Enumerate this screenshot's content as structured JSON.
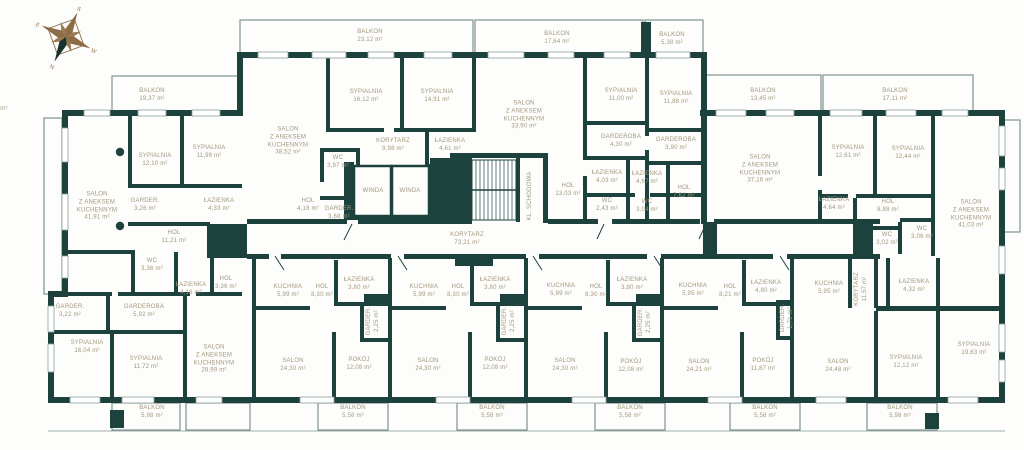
{
  "title": "Rzut kondygnacji / floor plan",
  "colors": {
    "wall": "#1d423e",
    "label_text": "#a3977f",
    "balcony_outline": "#7c948f",
    "compass_brown": "#8d6c48",
    "compass_dark": "#16332f",
    "background": "#fdfdfb"
  },
  "compass": {
    "n": "N",
    "s": "S",
    "e": "E",
    "w": "W"
  },
  "rooms": [
    {
      "n": "BALKON",
      "a": "19,37 m²",
      "x": 152,
      "y": 96
    },
    {
      "n": "BALKON",
      "a": "23,12 m²",
      "x": 370,
      "y": 37
    },
    {
      "n": "BALKON",
      "a": "17,64 m²",
      "x": 557,
      "y": 39
    },
    {
      "n": "BALKON",
      "a": "5,38 m²",
      "x": 672,
      "y": 40
    },
    {
      "n": "BALKON",
      "a": "13,45 m²",
      "x": 763,
      "y": 96
    },
    {
      "n": "BALKON",
      "a": "17,11 m²",
      "x": 895,
      "y": 96
    },
    {
      "n": "SALON\nZ ANEKSEM\nKUCHENNYM",
      "a": "41,91 m²",
      "x": 97,
      "y": 207
    },
    {
      "n": "SYPIALNIA",
      "a": "12,10 m²",
      "x": 155,
      "y": 161
    },
    {
      "n": "SYPIALNIA",
      "a": "11,99 m²",
      "x": 209,
      "y": 153
    },
    {
      "n": "GARDER.",
      "a": "3,26 m²",
      "x": 145,
      "y": 206
    },
    {
      "n": "ŁAZIENKA",
      "a": "4,33 m²",
      "x": 219,
      "y": 206
    },
    {
      "n": "HOL",
      "a": "11,21 m²",
      "x": 174,
      "y": 238
    },
    {
      "n": "WC",
      "a": "3,36 m²",
      "x": 152,
      "y": 266
    },
    {
      "n": "ŁAZIENKA",
      "a": "4,18 m²",
      "x": 191,
      "y": 290
    },
    {
      "n": "HOL",
      "a": "3,36 m²",
      "x": 226,
      "y": 284
    },
    {
      "n": "GARDER.",
      "a": "3,22 m²",
      "x": 70,
      "y": 312
    },
    {
      "n": "GARDEROBA",
      "a": "5,92 m²",
      "x": 144,
      "y": 312
    },
    {
      "n": "SYPIALNIA",
      "a": "16,04 m²",
      "x": 87,
      "y": 348
    },
    {
      "n": "SYPIALNIA",
      "a": "11,72 m²",
      "x": 146,
      "y": 364
    },
    {
      "n": "SALON\nZ ANEKSEM\nKUCHENNYM",
      "a": "28,99 m²",
      "x": 214,
      "y": 360
    },
    {
      "n": "SALON\nZ ANEKSEM\nKUCHENNYM",
      "a": "38,52 m²",
      "x": 288,
      "y": 142
    },
    {
      "n": "SYPIALNIA",
      "a": "16,12 m²",
      "x": 366,
      "y": 97
    },
    {
      "n": "SYPIALNIA",
      "a": "14,91 m²",
      "x": 437,
      "y": 97
    },
    {
      "n": "KORYTARZ",
      "a": "9,98 m²",
      "x": 393,
      "y": 146
    },
    {
      "n": "ŁAZIENKA",
      "a": "4,61 m²",
      "x": 450,
      "y": 146
    },
    {
      "n": "WC",
      "a": "3,97 m²",
      "x": 338,
      "y": 163
    },
    {
      "n": "HOL",
      "a": "4,18 m²",
      "x": 308,
      "y": 206
    },
    {
      "n": "GARDER.",
      "a": "3,68 m²",
      "x": 339,
      "y": 214
    },
    {
      "n": "WINDA",
      "a": "",
      "x": 373,
      "y": 192
    },
    {
      "n": "WINDA",
      "a": "",
      "x": 410,
      "y": 192
    },
    {
      "n": "KL. SCHODOWA",
      "a": "",
      "x": 531,
      "y": 196,
      "v": true
    },
    {
      "n": "HOL",
      "a": "13,03 m²",
      "x": 568,
      "y": 191
    },
    {
      "n": "KORYTARZ",
      "a": "73,21 m²",
      "x": 467,
      "y": 240
    },
    {
      "n": "SALON\nZ ANEKSEM\nKUCHENNYM",
      "a": "33,90 m²",
      "x": 524,
      "y": 116
    },
    {
      "n": "SYPIALNIA",
      "a": "11,00 m²",
      "x": 621,
      "y": 96
    },
    {
      "n": "SYPIALNIA",
      "a": "11,88 m²",
      "x": 676,
      "y": 99
    },
    {
      "n": "GARDEROBA",
      "a": "4,30 m²",
      "x": 621,
      "y": 142
    },
    {
      "n": "GARDEROBA",
      "a": "3,90 m²",
      "x": 676,
      "y": 145
    },
    {
      "n": "ŁAZIENKA",
      "a": "4,03 m²",
      "x": 607,
      "y": 178
    },
    {
      "n": "ŁAZIENKA",
      "a": "4,67 m²",
      "x": 647,
      "y": 179
    },
    {
      "n": "WC",
      "a": "2,43 m²",
      "x": 607,
      "y": 206
    },
    {
      "n": "WC",
      "a": "3,04 m²",
      "x": 647,
      "y": 207
    },
    {
      "n": "HOL",
      "a": "7,62 m²",
      "x": 684,
      "y": 193
    },
    {
      "n": "SALON\nZ ANEKSEM\nKUCHENNYM",
      "a": "37,16 m²",
      "x": 760,
      "y": 170
    },
    {
      "n": "SYPIALNIA",
      "a": "12,61 m²",
      "x": 848,
      "y": 153
    },
    {
      "n": "SYPIALNIA",
      "a": "12,44 m²",
      "x": 908,
      "y": 154
    },
    {
      "n": "ŁAZIENKA",
      "a": "4,64 m²",
      "x": 834,
      "y": 205
    },
    {
      "n": "HOL",
      "a": "8,88 m²",
      "x": 888,
      "y": 207
    },
    {
      "n": "WC",
      "a": "3,02 m²",
      "x": 887,
      "y": 240
    },
    {
      "n": "WC",
      "a": "3,06 m²",
      "x": 922,
      "y": 234
    },
    {
      "n": "SALON\nZ ANEKSEM\nKUCHENNYM",
      "a": "41,03 m²",
      "x": 971,
      "y": 215
    },
    {
      "n": "KUCHNIA",
      "a": "5,99 m²",
      "x": 288,
      "y": 292
    },
    {
      "n": "HOL",
      "a": "8,30 m²",
      "x": 322,
      "y": 292
    },
    {
      "n": "ŁAZIENKA",
      "a": "3,80 m²",
      "x": 359,
      "y": 285
    },
    {
      "n": "GARDER.",
      "a": "2,25 m²",
      "x": 374,
      "y": 321,
      "v": true
    },
    {
      "n": "SALON",
      "a": "24,30 m²",
      "x": 293,
      "y": 366
    },
    {
      "n": "POKÓJ",
      "a": "12,08 m²",
      "x": 359,
      "y": 365
    },
    {
      "n": "KUCHNIA",
      "a": "5,99 m²",
      "x": 424,
      "y": 292
    },
    {
      "n": "HOL",
      "a": "8,30 m²",
      "x": 458,
      "y": 292
    },
    {
      "n": "ŁAZIENKA",
      "a": "3,80 m²",
      "x": 495,
      "y": 285
    },
    {
      "n": "GARDER.",
      "a": "2,25 m²",
      "x": 510,
      "y": 321,
      "v": true
    },
    {
      "n": "SALON",
      "a": "24,30 m²",
      "x": 428,
      "y": 366
    },
    {
      "n": "POKÓJ",
      "a": "12,08 m²",
      "x": 495,
      "y": 365
    },
    {
      "n": "KUCHNIA",
      "a": "5,99 m²",
      "x": 561,
      "y": 291
    },
    {
      "n": "HOL",
      "a": "8,30 m²",
      "x": 596,
      "y": 292
    },
    {
      "n": "ŁAZIENKA",
      "a": "3,80 m²",
      "x": 632,
      "y": 285
    },
    {
      "n": "GARDER.",
      "a": "2,25 m²",
      "x": 646,
      "y": 322,
      "v": true
    },
    {
      "n": "SALON",
      "a": "24,30 m²",
      "x": 565,
      "y": 366
    },
    {
      "n": "POKÓJ",
      "a": "12,08 m²",
      "x": 631,
      "y": 367
    },
    {
      "n": "KUCHNIA",
      "a": "5,95 m²",
      "x": 693,
      "y": 291
    },
    {
      "n": "HOL",
      "a": "8,21 m²",
      "x": 730,
      "y": 292
    },
    {
      "n": "ŁAZIENKA",
      "a": "4,80 m²",
      "x": 766,
      "y": 288
    },
    {
      "n": "GARDER.",
      "a": "1,71 m²",
      "x": 788,
      "y": 318,
      "v": true
    },
    {
      "n": "SALON",
      "a": "24,21 m²",
      "x": 699,
      "y": 367
    },
    {
      "n": "POKÓJ",
      "a": "11,87 m²",
      "x": 763,
      "y": 366
    },
    {
      "n": "KUCHNIA",
      "a": "5,95 m²",
      "x": 829,
      "y": 289
    },
    {
      "n": "KORYTARZ",
      "a": "11,57 m²",
      "x": 862,
      "y": 289,
      "v": true
    },
    {
      "n": "ŁAZIENKA",
      "a": "4,32 m²",
      "x": 914,
      "y": 287
    },
    {
      "n": "SALON",
      "a": "24,48 m²",
      "x": 838,
      "y": 367
    },
    {
      "n": "SYPIALNIA",
      "a": "12,12 m²",
      "x": 906,
      "y": 363
    },
    {
      "n": "SYPIALNIA",
      "a": "19,63 m²",
      "x": 974,
      "y": 350
    },
    {
      "n": "BALKON",
      "a": "5,98 m²",
      "x": 152,
      "y": 413
    },
    {
      "n": "BALKON",
      "a": "5,58 m²",
      "x": 353,
      "y": 413
    },
    {
      "n": "BALKON",
      "a": "5,58 m²",
      "x": 492,
      "y": 413
    },
    {
      "n": "BALKON",
      "a": "5,58 m²",
      "x": 630,
      "y": 413
    },
    {
      "n": "BALKON",
      "a": "5,58 m²",
      "x": 765,
      "y": 413
    },
    {
      "n": "BALKON",
      "a": "5,98 m²",
      "x": 900,
      "y": 413
    },
    {
      "n": "",
      "a": "m²",
      "x": 4,
      "y": 110
    }
  ]
}
